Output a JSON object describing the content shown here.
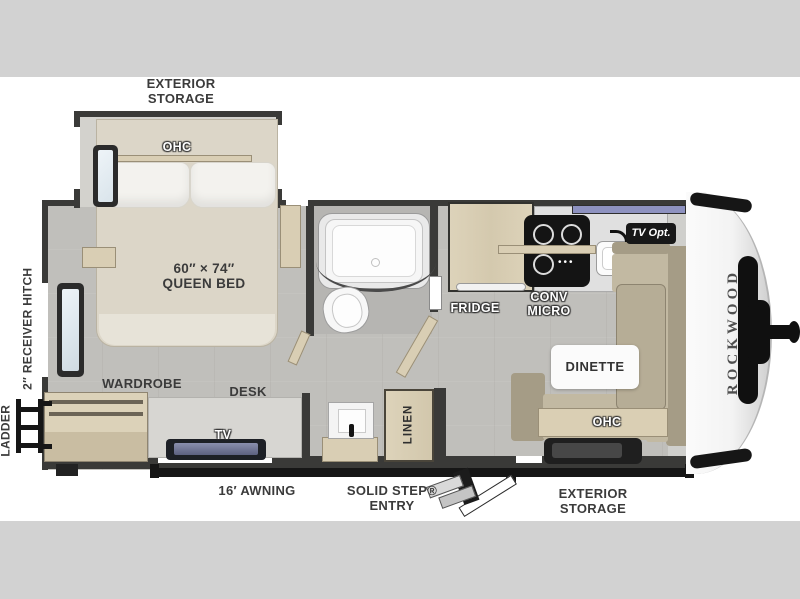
{
  "floorplan": {
    "brand": "ROCKWOOD",
    "labels": {
      "exterior_storage_top": [
        "EXTERIOR",
        "STORAGE"
      ],
      "bedroom_ohc": "OHC",
      "bed_size": "60″ × 74″",
      "bed_type": "QUEEN BED",
      "receiver_hitch": "2″ RECEIVER HITCH",
      "ladder": "LADDER",
      "wardrobe": "WARDROBE",
      "desk": "DESK",
      "tv": "TV",
      "linen": "LINEN",
      "fridge": "FRIDGE",
      "conv_micro": [
        "CONV",
        "MICRO"
      ],
      "tv_opt": "TV Opt.",
      "dinette": "DINETTE",
      "dinette_ohc": "OHC",
      "awning": "16′ AWNING",
      "solid_step_entry": [
        "SOLID STEP®",
        "ENTRY"
      ],
      "exterior_storage_bottom": [
        "EXTERIOR",
        "STORAGE"
      ]
    },
    "icons": {
      "burner_knobs": "•••"
    },
    "colors": {
      "page_band": "#d2d2d2",
      "wall": "#3a3a38",
      "floor": "#c0bfbb",
      "wood_cabinet": "#d9ceb4",
      "bed": "#dcd6c8",
      "dinette_cushion": "#c2b9a2",
      "dinette_back": "#a59c86",
      "front_window": "#8e92c0",
      "label_text": "#3b3b3b",
      "black_accent": "#161616"
    }
  }
}
